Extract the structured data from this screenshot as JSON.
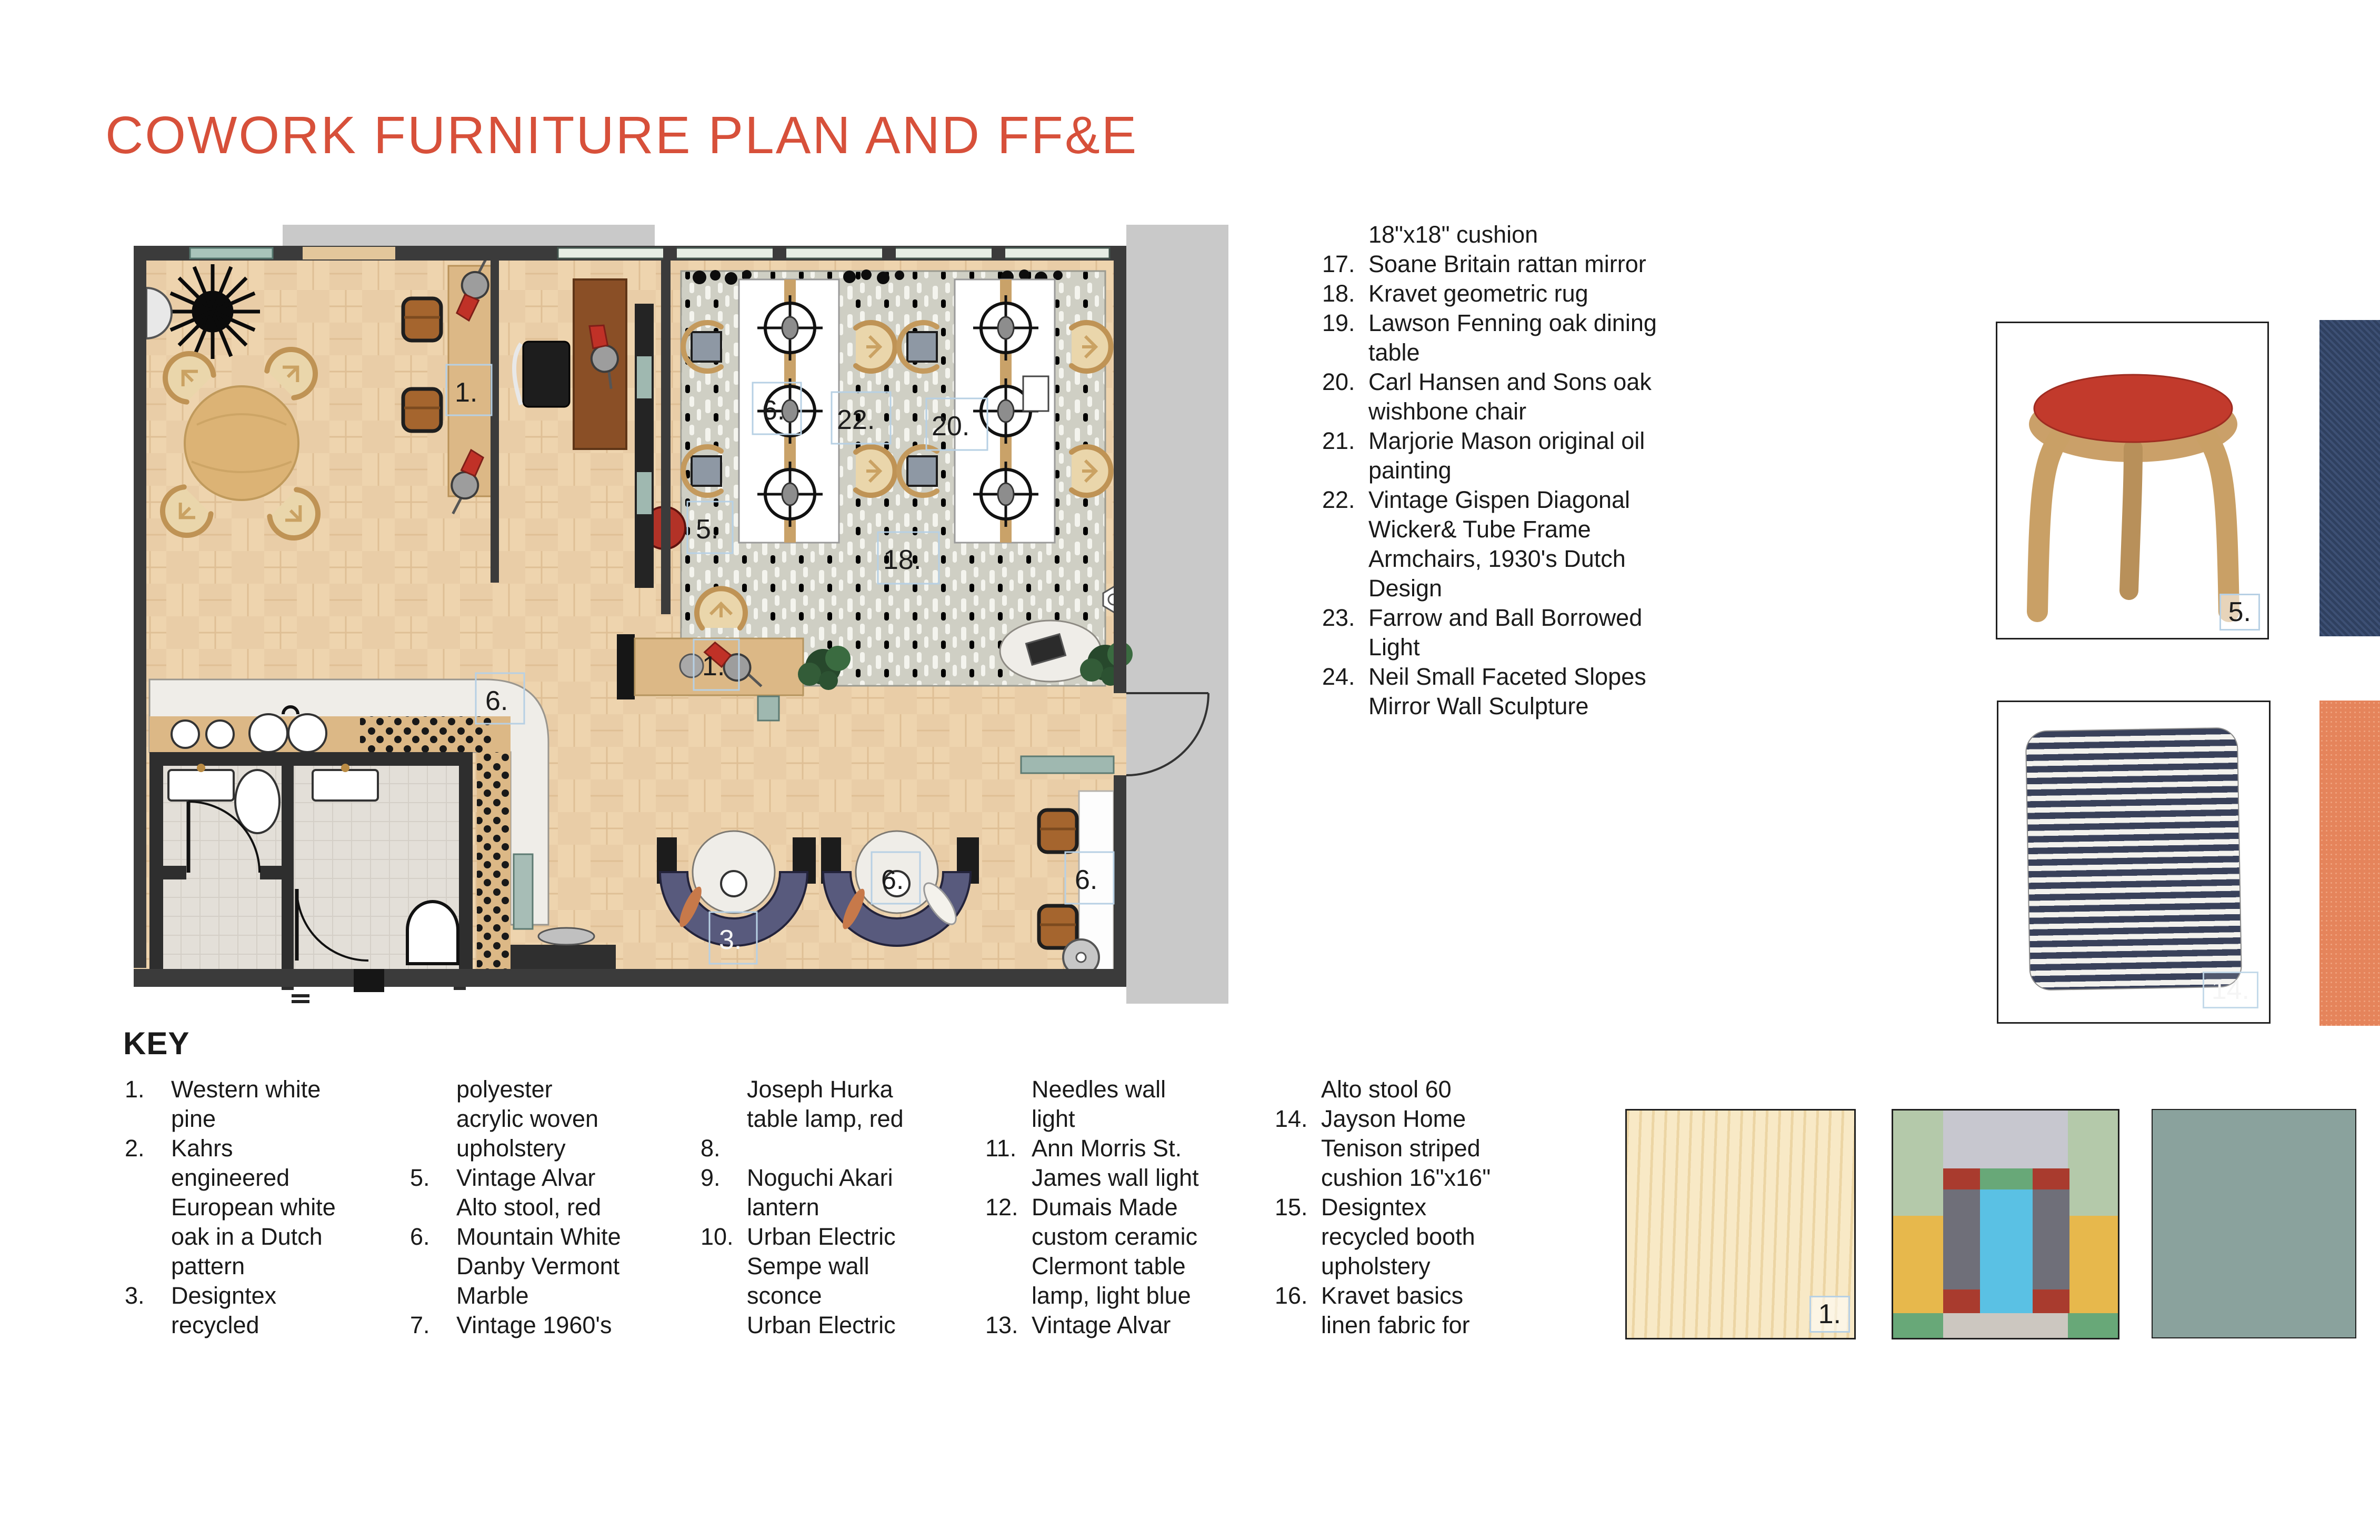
{
  "title": "COWORK FURNITURE PLAN AND FF&E",
  "colors": {
    "accent": "#d7503a",
    "wall": "#3b3b3b",
    "floor": "#e8cba5",
    "rug": "#cfcfc4",
    "booth_purple": "#585a7d",
    "teal": "#9fb8b0",
    "marble": "#efede8",
    "stool_red": "#b23227",
    "navy_fabric": "#2f4060",
    "orange_linen": "#e5845b",
    "sage": "#8aa29d",
    "wood": "#d9b77f"
  },
  "plan": {
    "labels": [
      "1.",
      "6.",
      "22.",
      "20.",
      "5.",
      "18.",
      "1.",
      "6.",
      "3.",
      "6.",
      "6."
    ]
  },
  "ffe": {
    "items": [
      {
        "num": "",
        "text": "18\"x18\" cushion"
      },
      {
        "num": "17.",
        "text": "Soane Britain rattan mirror"
      },
      {
        "num": "18.",
        "text": "Kravet geometric rug"
      },
      {
        "num": "19.",
        "text": "Lawson Fenning oak dining\ntable"
      },
      {
        "num": "20.",
        "text": "Carl Hansen and Sons oak\nwishbone chair"
      },
      {
        "num": "21.",
        "text": "Marjorie Mason original oil\npainting"
      },
      {
        "num": "22.",
        "text": "Vintage Gispen Diagonal\nWicker& Tube Frame\nArmchairs, 1930's Dutch\nDesign"
      },
      {
        "num": "23.",
        "text": "Farrow and Ball Borrowed\nLight"
      },
      {
        "num": "24.",
        "text": "Neil Small Faceted Slopes\nMirror Wall Sculpture"
      }
    ]
  },
  "key": {
    "heading": "KEY",
    "columns": [
      {
        "items": [
          {
            "num": "1.",
            "text": "Western white\npine"
          },
          {
            "num": "2.",
            "text": "Kahrs\nengineered\nEuropean white\noak in a Dutch\npattern"
          },
          {
            "num": "3.",
            "text": "Designtex\nrecycled"
          }
        ]
      },
      {
        "items": [
          {
            "num": "",
            "text": "polyester\nacrylic woven\nupholstery"
          },
          {
            "num": "5.",
            "text": "Vintage Alvar\nAlto stool, red"
          },
          {
            "num": "6.",
            "text": "Mountain White\nDanby Vermont\nMarble"
          },
          {
            "num": "7.",
            "text": "Vintage 1960's"
          }
        ]
      },
      {
        "items": [
          {
            "num": "",
            "text": "Joseph Hurka\ntable lamp, red"
          },
          {
            "num": "8.",
            "text": ""
          },
          {
            "num": "9.",
            "text": "Noguchi Akari\nlantern"
          },
          {
            "num": "10.",
            "text": "Urban Electric\nSempe wall\nsconce\nUrban Electric"
          }
        ]
      },
      {
        "items": [
          {
            "num": "",
            "text": "Needles wall\nlight"
          },
          {
            "num": "11.",
            "text": "Ann Morris St.\nJames wall light"
          },
          {
            "num": "12.",
            "text": "Dumais Made\ncustom ceramic\nClermont table\nlamp, light blue"
          },
          {
            "num": "13.",
            "text": "Vintage Alvar"
          }
        ]
      },
      {
        "items": [
          {
            "num": "",
            "text": "Alto stool 60"
          },
          {
            "num": "14.",
            "text": "Jayson Home\nTenison striped\ncushion 16\"x16\""
          },
          {
            "num": "15.",
            "text": "Designtex\nrecycled booth\nupholstery"
          },
          {
            "num": "16.",
            "text": "Kravet basics\nlinen fabric for"
          }
        ]
      }
    ]
  },
  "swatches": {
    "stool_label": "5.",
    "pillow_label": "14.",
    "wood_label": "1."
  }
}
